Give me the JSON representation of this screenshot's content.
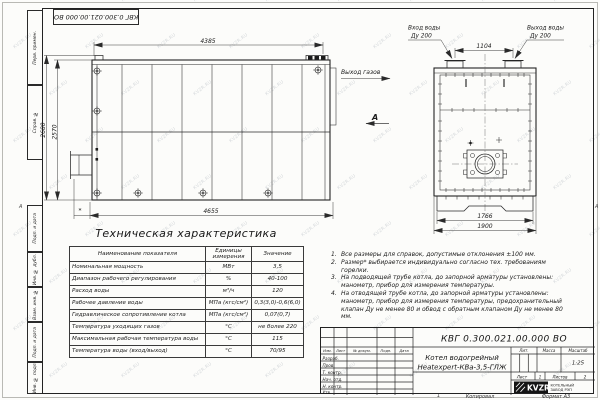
{
  "sheet": {
    "doc_number": "КВГ 0.300.021.00.000 ВО",
    "watermark": "KVZR.RU",
    "zone_letter": "А",
    "zone_number": "1",
    "copied_label": "Копировал",
    "format_label": "Формат А3"
  },
  "frame": {
    "left_labels": [
      "Перв. примен.",
      "Справ. №",
      "Подп. и дата",
      "Инв. № дубл.",
      "Взам. инв. №",
      "Подп. и дата",
      "Инв. № подл."
    ]
  },
  "views": {
    "side": {
      "dim_top": "4385",
      "dim_bottom": "4655",
      "dim_left_outer": "2680",
      "dim_left_inner": "2570",
      "dim_star": "*",
      "gas_outlet": "Выход газов",
      "view_letter": "А"
    },
    "front": {
      "inlet_line1": "Вход воды",
      "inlet_line2": "Ду 200",
      "outlet_line1": "Выход воды",
      "outlet_line2": "Ду 200",
      "dim_nozzles": "1104",
      "dim_base": "1766",
      "dim_width": "1900"
    }
  },
  "spec_table": {
    "title": "Техническая характеристика",
    "headers": [
      "Наименование показателя",
      "Единицы измерения",
      "Значение"
    ],
    "rows": [
      {
        "name": "Номинальная мощность",
        "unit": "МВт",
        "value": "3,5"
      },
      {
        "name": "Диапазон рабочего регулирования",
        "unit": "%",
        "value": "40-100"
      },
      {
        "name": "Расход воды",
        "unit": "м³/ч",
        "value": "120"
      },
      {
        "name": "Рабочее давление воды",
        "unit": "МПа (кгс/см²)",
        "value": "0,3(3,0)-0,6(6,0)"
      },
      {
        "name": "Гидравлическое сопротивление котла",
        "unit": "МПа (кгс/см²)",
        "value": "0,07(0,7)"
      },
      {
        "name": "Температура уходящих газов",
        "unit": "°С",
        "value": "не более 220"
      },
      {
        "name": "Максимальная рабочая температура воды",
        "unit": "°С",
        "value": "115"
      },
      {
        "name": "Температура воды (вход/выход)",
        "unit": "°С",
        "value": "70/95"
      }
    ]
  },
  "notes": {
    "items": [
      {
        "num": "1.",
        "text": "Все размеры для справок, допустимые отклонения ±100 мм."
      },
      {
        "num": "2.",
        "text": "Размер* выбирается индивидуально согласно тех. требованиям горелки."
      },
      {
        "num": "3.",
        "text": "На подводящей трубе котла, до запорной арматуры установлены: манометр, прибор для измерения температуры."
      },
      {
        "num": "4.",
        "text": "На отводящей трубе котла, до запорной арматуры установлены: манометр, прибор для измерения температуры, предохранительный клапан Ду не менее 80 и обвод с обратным клапаном Ду не менее 80 мм."
      }
    ]
  },
  "title_block": {
    "doc_number": "КВГ 0.300.021.00.000 ВО",
    "product_line1": "Котел водогрейный",
    "product_line2": "Heatexpert-КВа-3,5-ГЛЖ",
    "lit_label": "Лит.",
    "mass_label": "Масса",
    "scale_label": "Масштаб",
    "scale_value": "1:25",
    "sheet_label": "Лист",
    "sheet_value": "1",
    "sheets_label": "Листов",
    "sheets_value": "2",
    "sig_headers": [
      "Изм.",
      "Лист",
      "№ докум.",
      "Подп.",
      "Дата"
    ],
    "sig_rows": [
      "Разраб.",
      "Пров.",
      "Т. контр.",
      "Нач. отд.",
      "Н. контр.",
      "Утв."
    ],
    "logo_text": "KVZR",
    "company_line1": "КОТЕЛЬНЫЙ",
    "company_line2": "ЗАВОД РЭП"
  }
}
